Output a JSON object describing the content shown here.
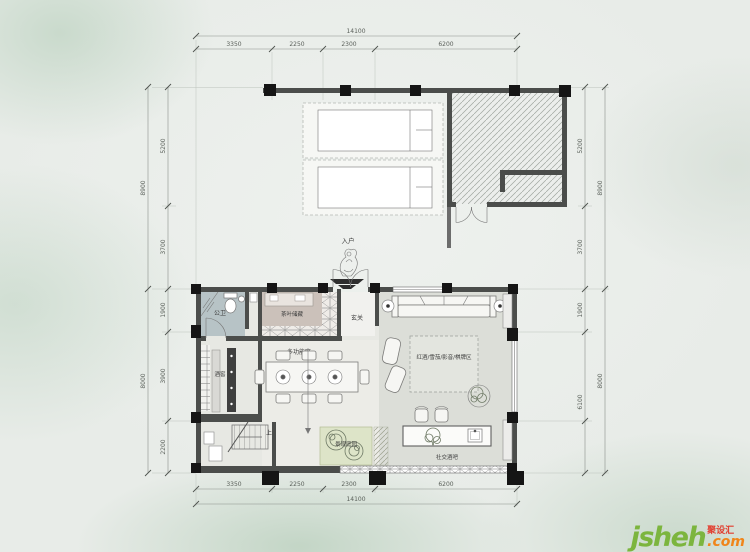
{
  "watermark": {
    "name": "jsheh",
    "tld": ".com",
    "badge": "聚设汇"
  },
  "entry": {
    "label": "入户"
  },
  "stairs": {
    "up": "上"
  },
  "rooms": {
    "bathroom": "公卫",
    "tea_storage": "茶叶储藏",
    "foyer": "玄关",
    "multi_function": "多功能区",
    "wine_cellar": "酒窖",
    "lounge": "红酒/雪茄/影音/棋牌区",
    "garden": "景观庭园",
    "bar": "社交酒吧"
  },
  "dims": {
    "top": {
      "total": "14100",
      "segments": [
        "3350",
        "2250",
        "2300",
        "6200"
      ]
    },
    "bottom": {
      "total": "14100",
      "segments": [
        "3350",
        "2250",
        "2300",
        "6200"
      ]
    },
    "left": {
      "outer": [
        "8900",
        "8000"
      ],
      "inner": [
        "5200",
        "3700",
        "1900",
        "3900",
        "2200"
      ]
    },
    "right": {
      "outer": [
        "8900",
        "8000"
      ],
      "inner": [
        "5200",
        "3700",
        "1900",
        "6100"
      ]
    }
  }
}
